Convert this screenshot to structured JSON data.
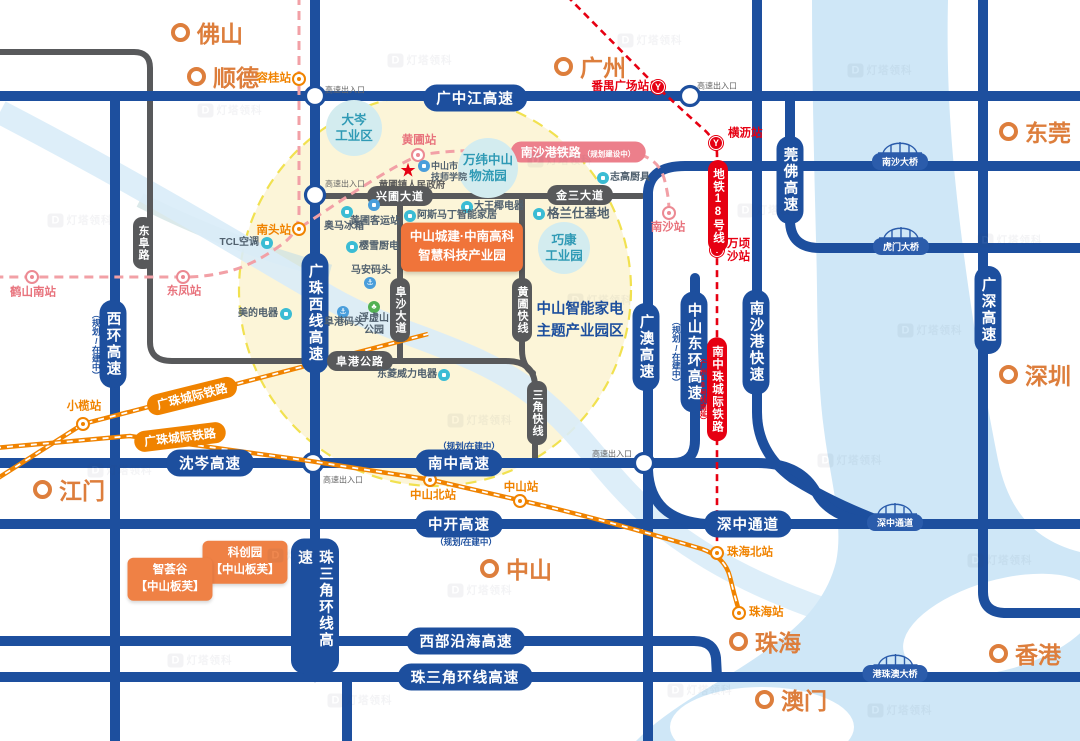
{
  "cities": [
    {
      "name": "佛山"
    },
    {
      "name": "顺德"
    },
    {
      "name": "广州"
    },
    {
      "name": "东莞"
    },
    {
      "name": "深圳"
    },
    {
      "name": "江门"
    },
    {
      "name": "中山"
    },
    {
      "name": "珠海"
    },
    {
      "name": "香港"
    },
    {
      "name": "澳门"
    }
  ],
  "stations": [
    {
      "name": "容桂站",
      "line_color": "orange"
    },
    {
      "name": "南头站",
      "line_color": "orange"
    },
    {
      "name": "小榄站",
      "line_color": "orange"
    },
    {
      "name": "中山北站",
      "line_color": "orange"
    },
    {
      "name": "中山站",
      "line_color": "orange"
    },
    {
      "name": "珠海北站",
      "line_color": "orange"
    },
    {
      "name": "珠海站",
      "line_color": "orange"
    },
    {
      "name": "黄圃站",
      "line_color": "pink"
    },
    {
      "name": "东凤站",
      "line_color": "pink"
    },
    {
      "name": "鹤山南站",
      "line_color": "pink"
    },
    {
      "name": "南沙站",
      "line_color": "pink"
    },
    {
      "name": "番禺广场站",
      "line_color": "red"
    },
    {
      "name": "横沥站",
      "line_color": "red"
    },
    {
      "name": "万顷沙站",
      "line_color": "red"
    }
  ],
  "highways": [
    {
      "label": "广中江高速"
    },
    {
      "label": "沈岑高速"
    },
    {
      "label": "南中高速",
      "status_note": "（规划/在建中）"
    },
    {
      "label": "中开高速",
      "status_note": "（规划/在建中）"
    },
    {
      "label": "深中通道"
    },
    {
      "label": "西部沿海高速"
    },
    {
      "label": "珠三角环线高速"
    },
    {
      "label": "西环高速",
      "status_note": "（规划/在建中）"
    },
    {
      "label": "广珠西线高速"
    },
    {
      "label": "珠三角环线高速"
    },
    {
      "label": "广澳高速"
    },
    {
      "label": "中山东环高速",
      "status_note": "（规划/在建中）"
    },
    {
      "label": "南沙港快速"
    },
    {
      "label": "莞佛高速"
    },
    {
      "label": "广深高速"
    }
  ],
  "roads": [
    {
      "label": "兴圃大道"
    },
    {
      "label": "金三大道"
    },
    {
      "label": "阜港公路"
    },
    {
      "label": "阜沙大道"
    },
    {
      "label": "东阜路"
    },
    {
      "label": "黄圃快线"
    },
    {
      "label": "三角快线"
    }
  ],
  "railways": [
    {
      "label": "广珠城际铁路"
    },
    {
      "label": "广珠城际铁路"
    },
    {
      "label": "南沙港铁路",
      "status_note": "（规划建设中）"
    },
    {
      "label": "南中珠城际铁路",
      "status_note": "（广州18号线南延）"
    },
    {
      "label": "地铁18号线"
    }
  ],
  "bridges": [
    {
      "label": "南沙大桥"
    },
    {
      "label": "虎门大桥"
    },
    {
      "label": "深中通道"
    },
    {
      "label": "港珠澳大桥"
    }
  ],
  "industry_zones": [
    {
      "lines": [
        "大岑",
        "工业区"
      ]
    },
    {
      "lines": [
        "万纬中山",
        "物流园"
      ]
    },
    {
      "lines": [
        "巧康",
        "工业园"
      ]
    }
  ],
  "project_badge": {
    "lines": [
      "中山城建·中南高科",
      "智慧科技产业园"
    ]
  },
  "theme_park_label": {
    "lines": [
      "中山智能家电",
      "主题产业园区"
    ]
  },
  "project_badges": [
    {
      "lines": [
        "科创园",
        "【中山板芙】"
      ]
    },
    {
      "lines": [
        "智荟谷",
        "【中山板芙】"
      ]
    }
  ],
  "pois": [
    {
      "name": "TCL空调"
    },
    {
      "name": "美的电器"
    },
    {
      "name": "奥马冰箱"
    },
    {
      "name": "黄圃客运站"
    },
    {
      "lines": [
        "中山市",
        "技师学院"
      ]
    },
    {
      "name": "大王椰电器"
    },
    {
      "name": "阿斯马丁智能家居"
    },
    {
      "name": "格兰仕基地"
    },
    {
      "name": "志高厨具"
    },
    {
      "name": "樱雪厨电"
    },
    {
      "name": "马安码头"
    },
    {
      "name": "阜港码头"
    },
    {
      "lines": [
        "浮虚山",
        "公园"
      ]
    },
    {
      "name": "东菱威力电器"
    }
  ],
  "government": {
    "name": "黄圃镇人民政府"
  },
  "exit_label": "高速出入口",
  "watermark": {
    "logo": "D",
    "text": "灯塔领科"
  },
  "colors": {
    "highway_blue": "#1d4f9e",
    "road_gray": "#58595b",
    "rail_orange": "#f08300",
    "rail_pink": "#ec8a93",
    "metro_red": "#e60012",
    "city_orange": "#dd7e3c",
    "water": "#cfe7f7",
    "focus_fill": "#fcf5d8",
    "focus_border": "#f1e150",
    "zone_fill": "#d3ecef",
    "zone_text": "#2f9ab5",
    "badge_orange": "#f0743a"
  }
}
